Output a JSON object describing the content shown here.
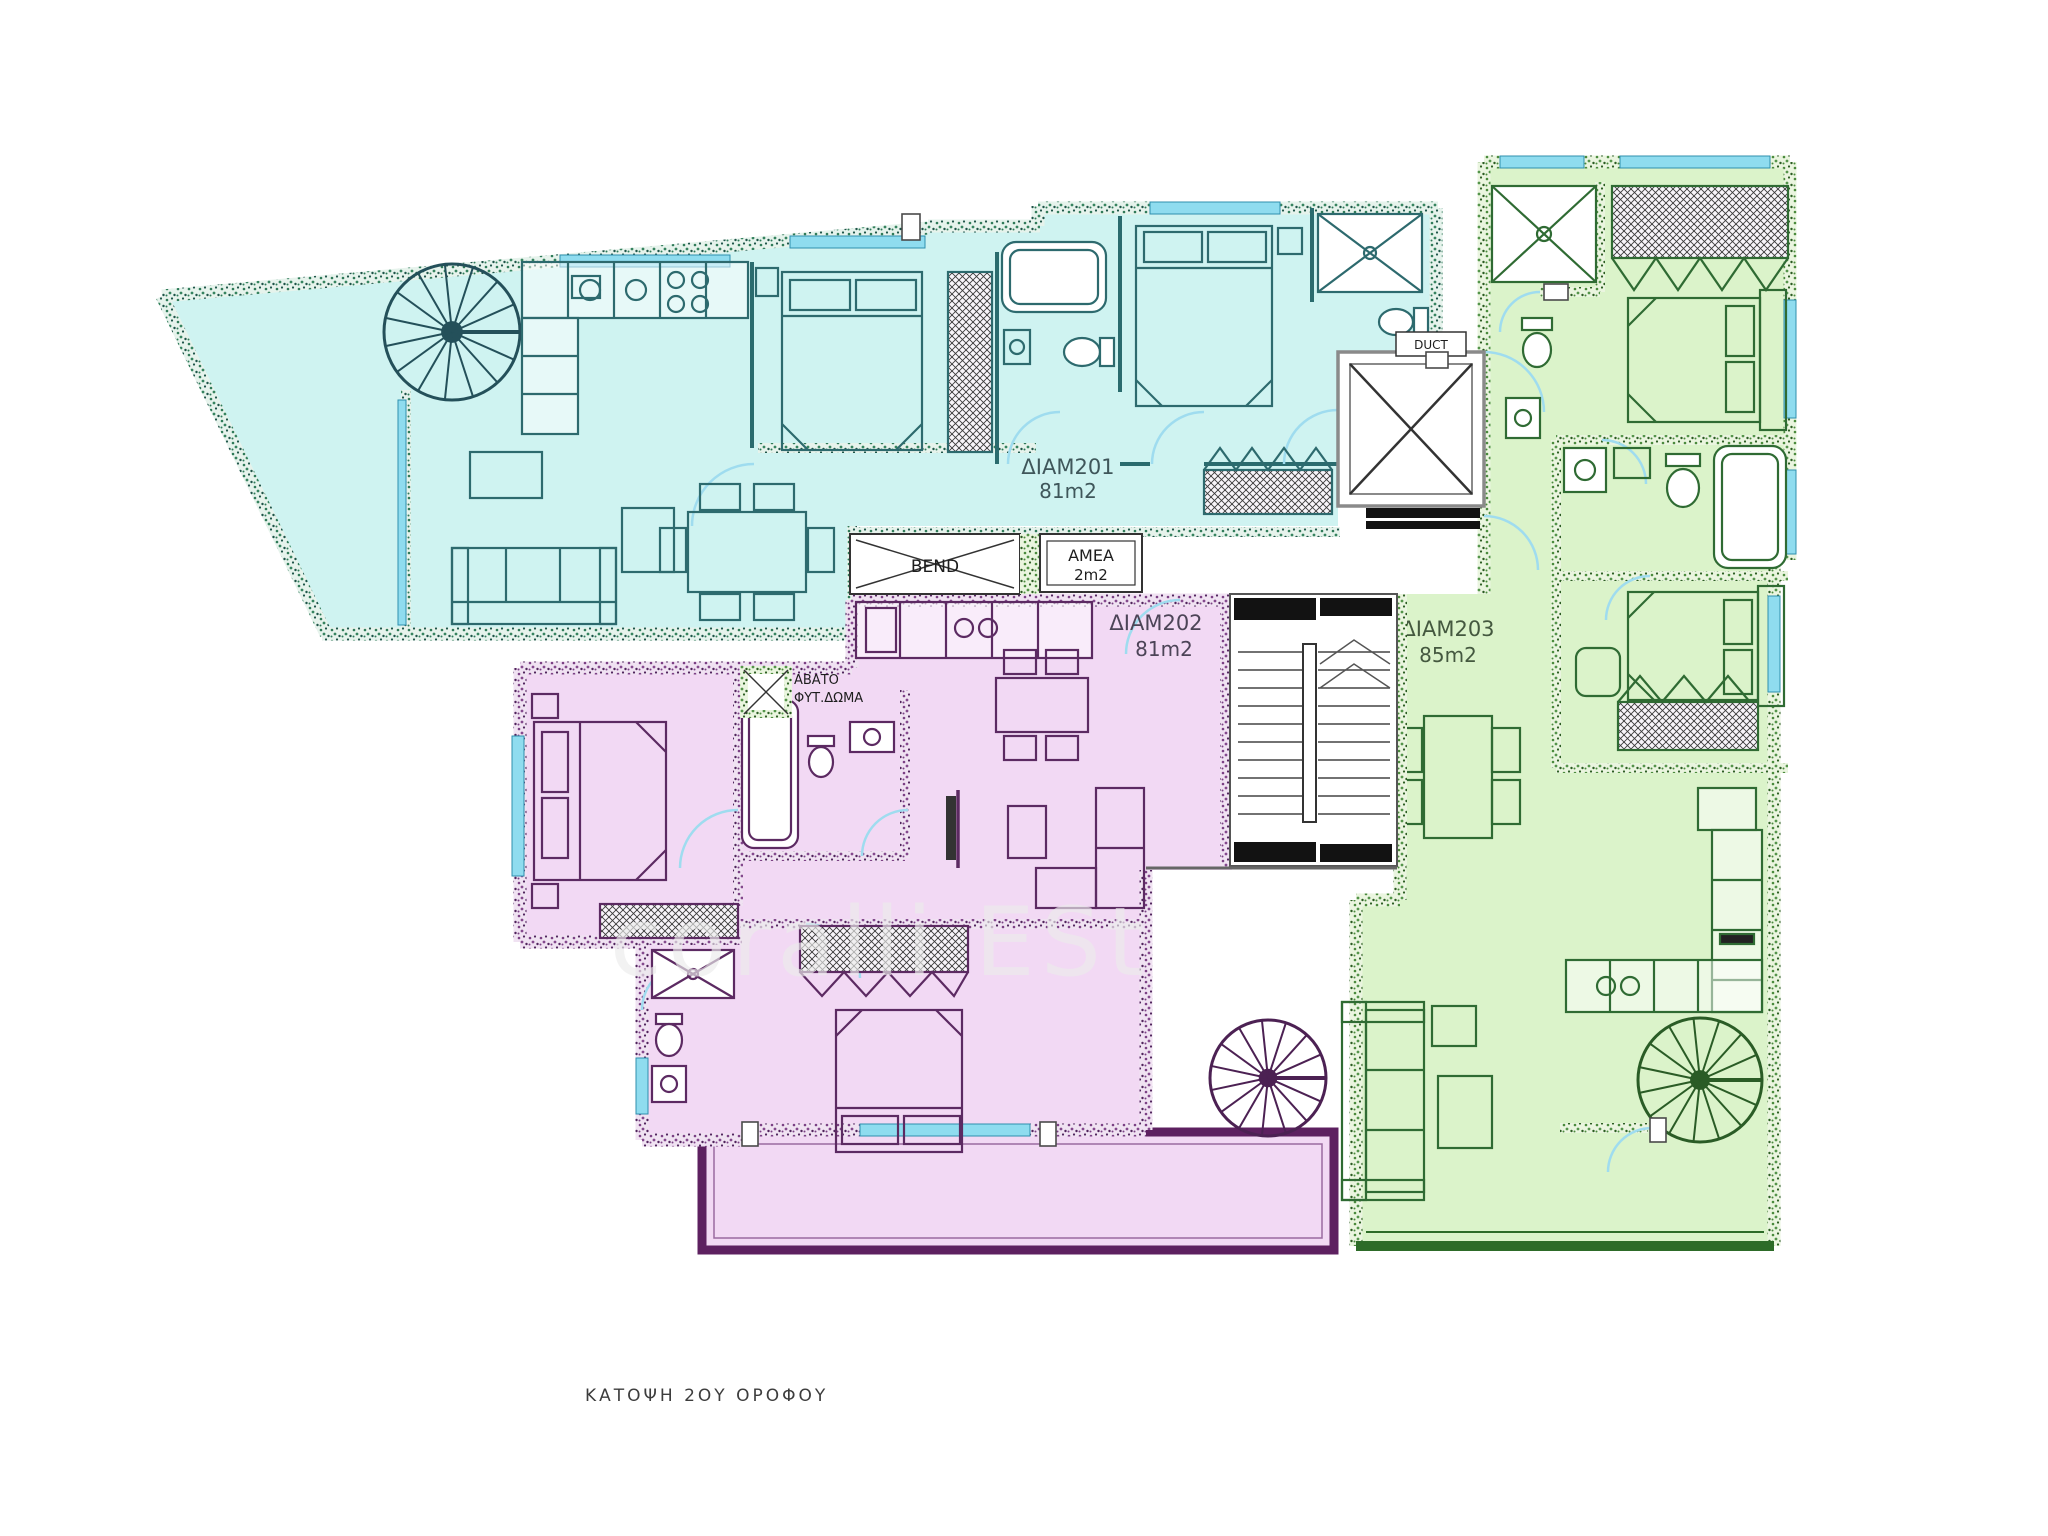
{
  "title": "ΚΑΤΟΨΗ 2ΟΥ ΟΡΟΦΟΥ",
  "watermark": "coralli ESt",
  "apartments": [
    {
      "name": "ΔΙΑΜ201",
      "area": "81m2",
      "fill": "#cff3f1",
      "wall_color": "#2a6b6e"
    },
    {
      "name": "ΔΙΑΜ202",
      "area": "81m2",
      "fill": "#f2d9f4",
      "wall_color": "#5e2a63"
    },
    {
      "name": "ΔΙΑΜ203",
      "area": "85m2",
      "fill": "#dbf3ca",
      "wall_color": "#2e7d32"
    }
  ],
  "core": {
    "duct_label": "DUCT",
    "shaft_label": "BEND",
    "amea_label": "AMEA",
    "amea_area": "2m2",
    "lightwell_line1": "ΑΒΑΤΟ",
    "lightwell_line2": "ΦΥΤ.ΔΩΜΑ"
  },
  "colors": {
    "glazing": "#8fdcef",
    "door_arc": "#9fdcef",
    "terrace_border_pink": "#5d2060",
    "terrace_border_green": "#2d6b28",
    "core_black": "#111111"
  }
}
